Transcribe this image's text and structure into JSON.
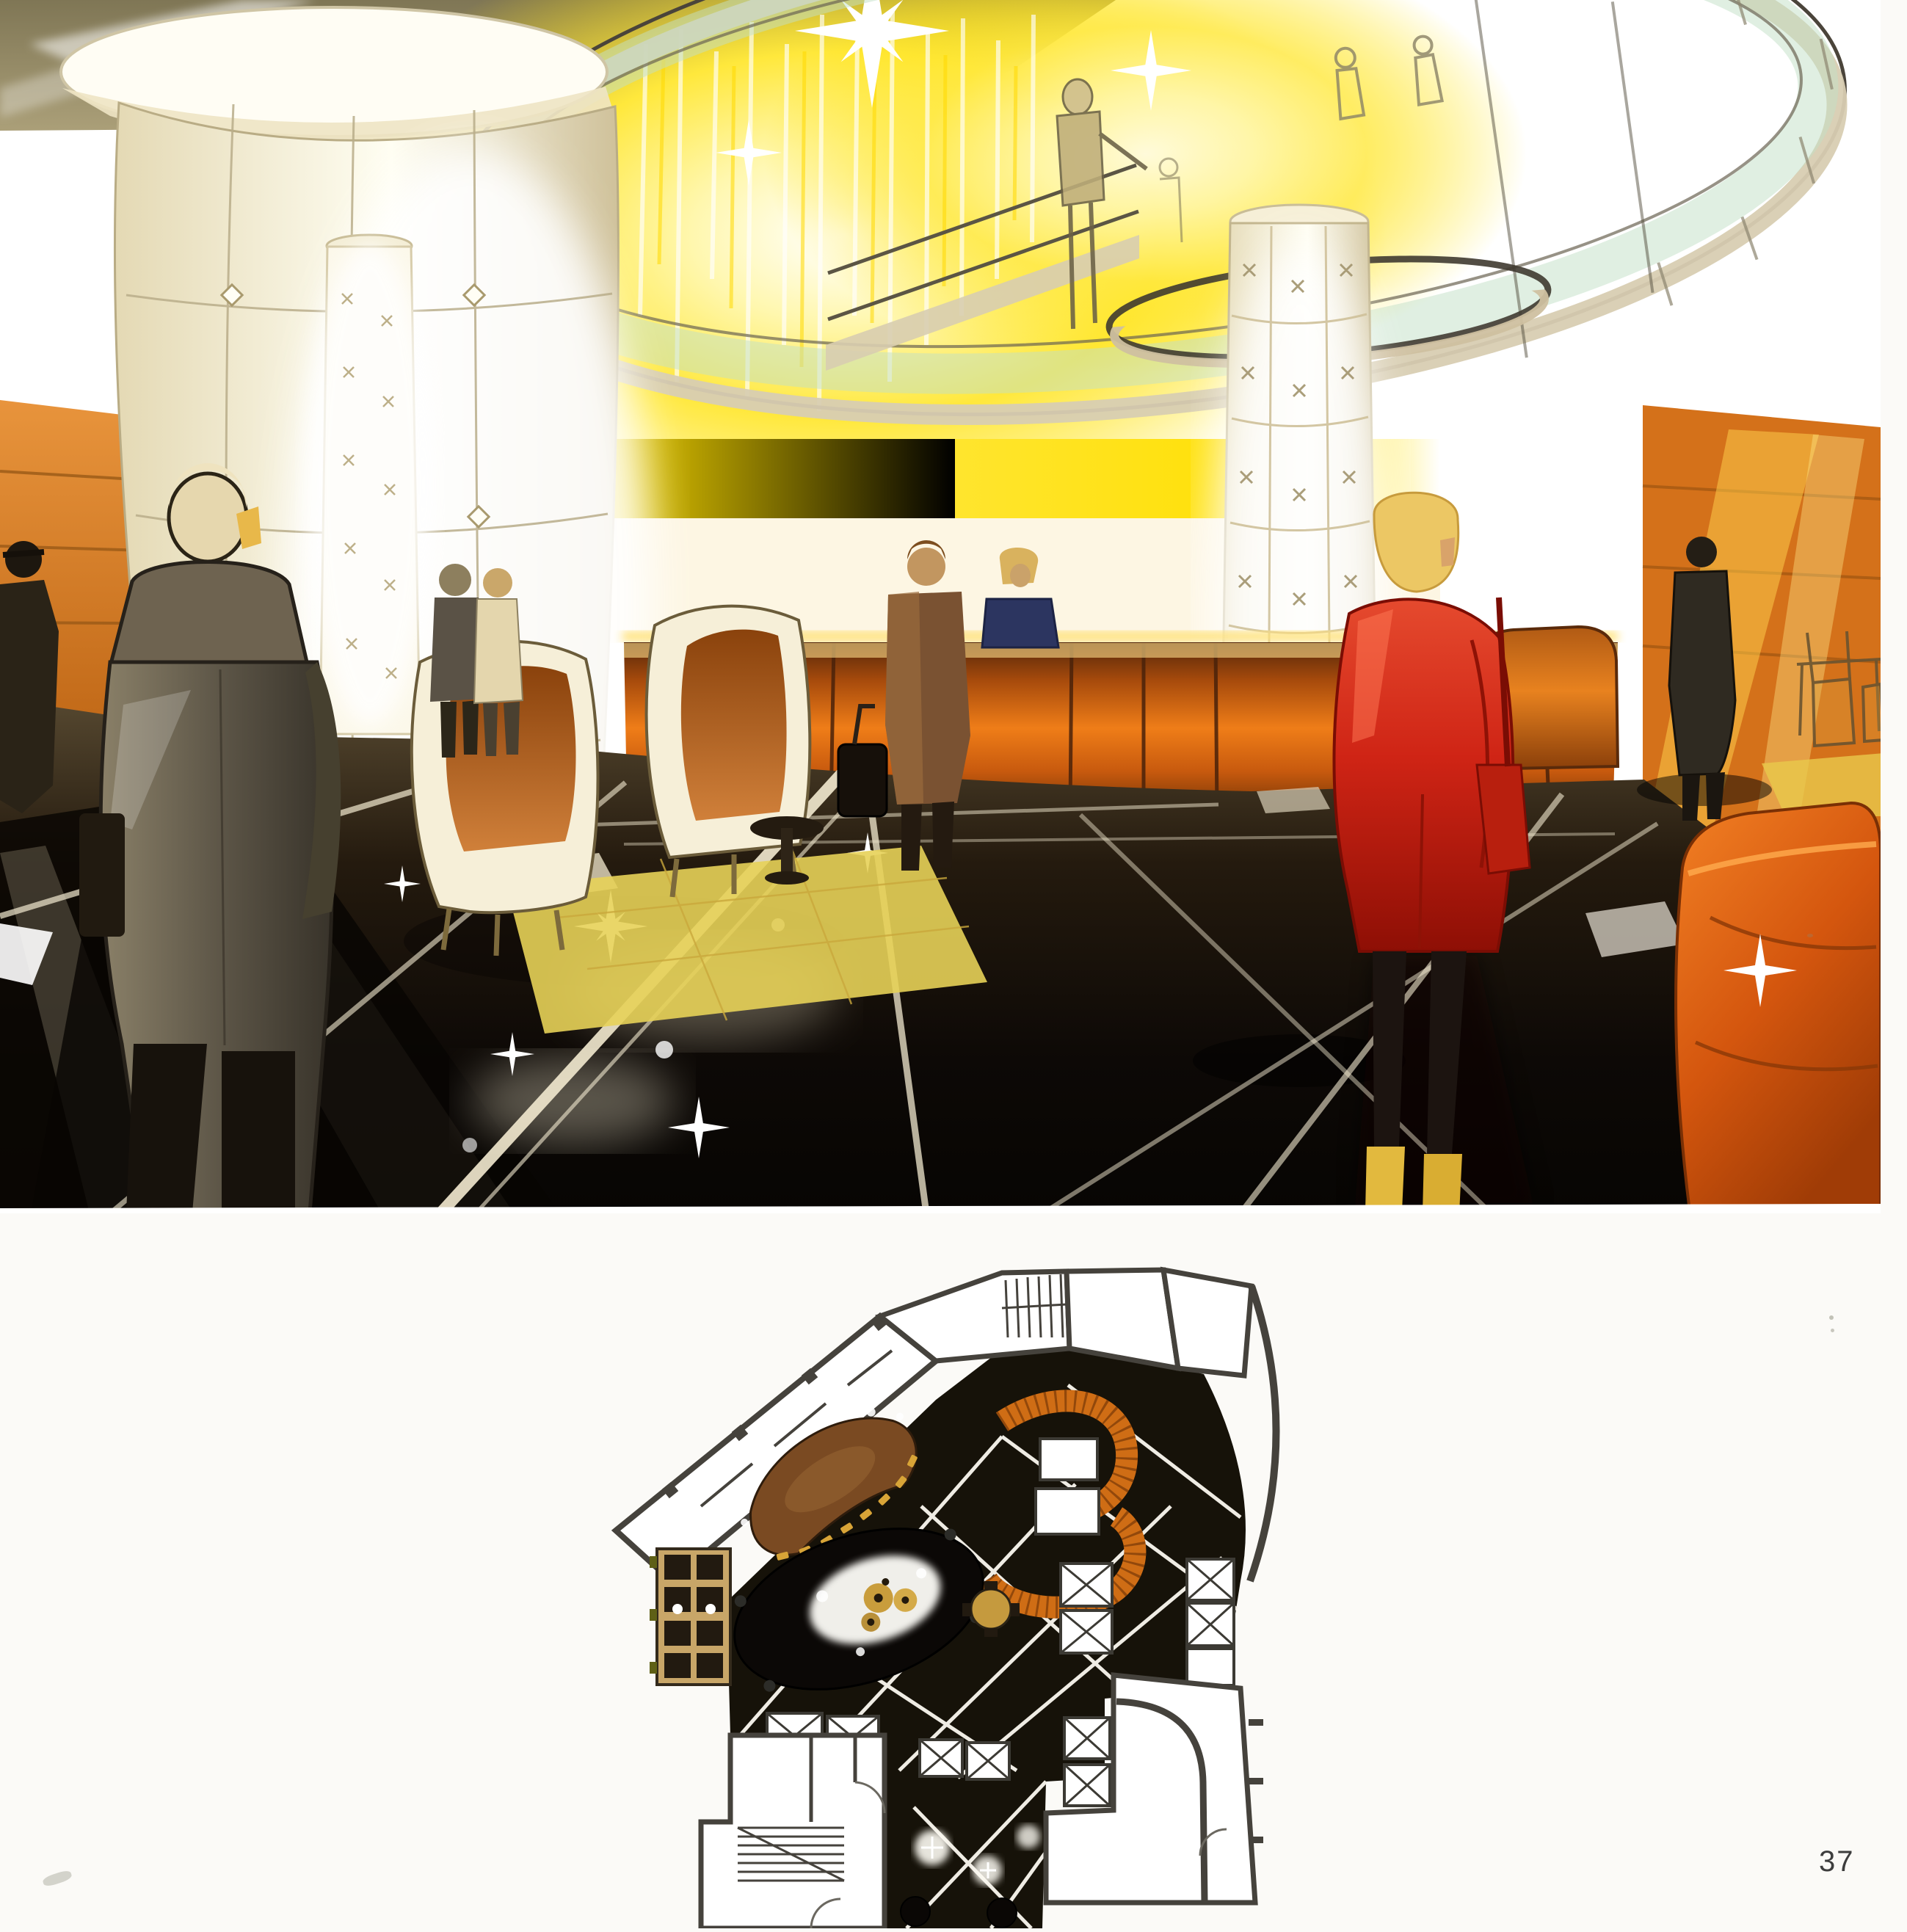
{
  "page": {
    "number": "37"
  },
  "figures": {
    "rendering": {
      "name": "hotel-lobby-interior-rendering"
    },
    "plan": {
      "name": "lobby-ground-floor-plan"
    }
  },
  "theme": {
    "page_bg": "#fbfaf7",
    "page_number_color": "#3d3d3d",
    "glow_yellow": "#f6d500",
    "ceiling_olive": "#9a8e6b",
    "column_cream": "#f6efd7",
    "wall_orange": "#d47a1f",
    "desk_copper": "#c0590e",
    "red_jacket": "#cf2415",
    "boot_yellow": "#e2b93e",
    "floor_dark": "#1b140c",
    "plan_wall_gray": "#45423c",
    "plan_floor_dark": "#161209",
    "plan_desk_brown": "#7a4a22",
    "plan_stair_orange": "#cf6d15",
    "plan_seating_tan": "#c8a668",
    "plan_gold": "#d8a437"
  }
}
